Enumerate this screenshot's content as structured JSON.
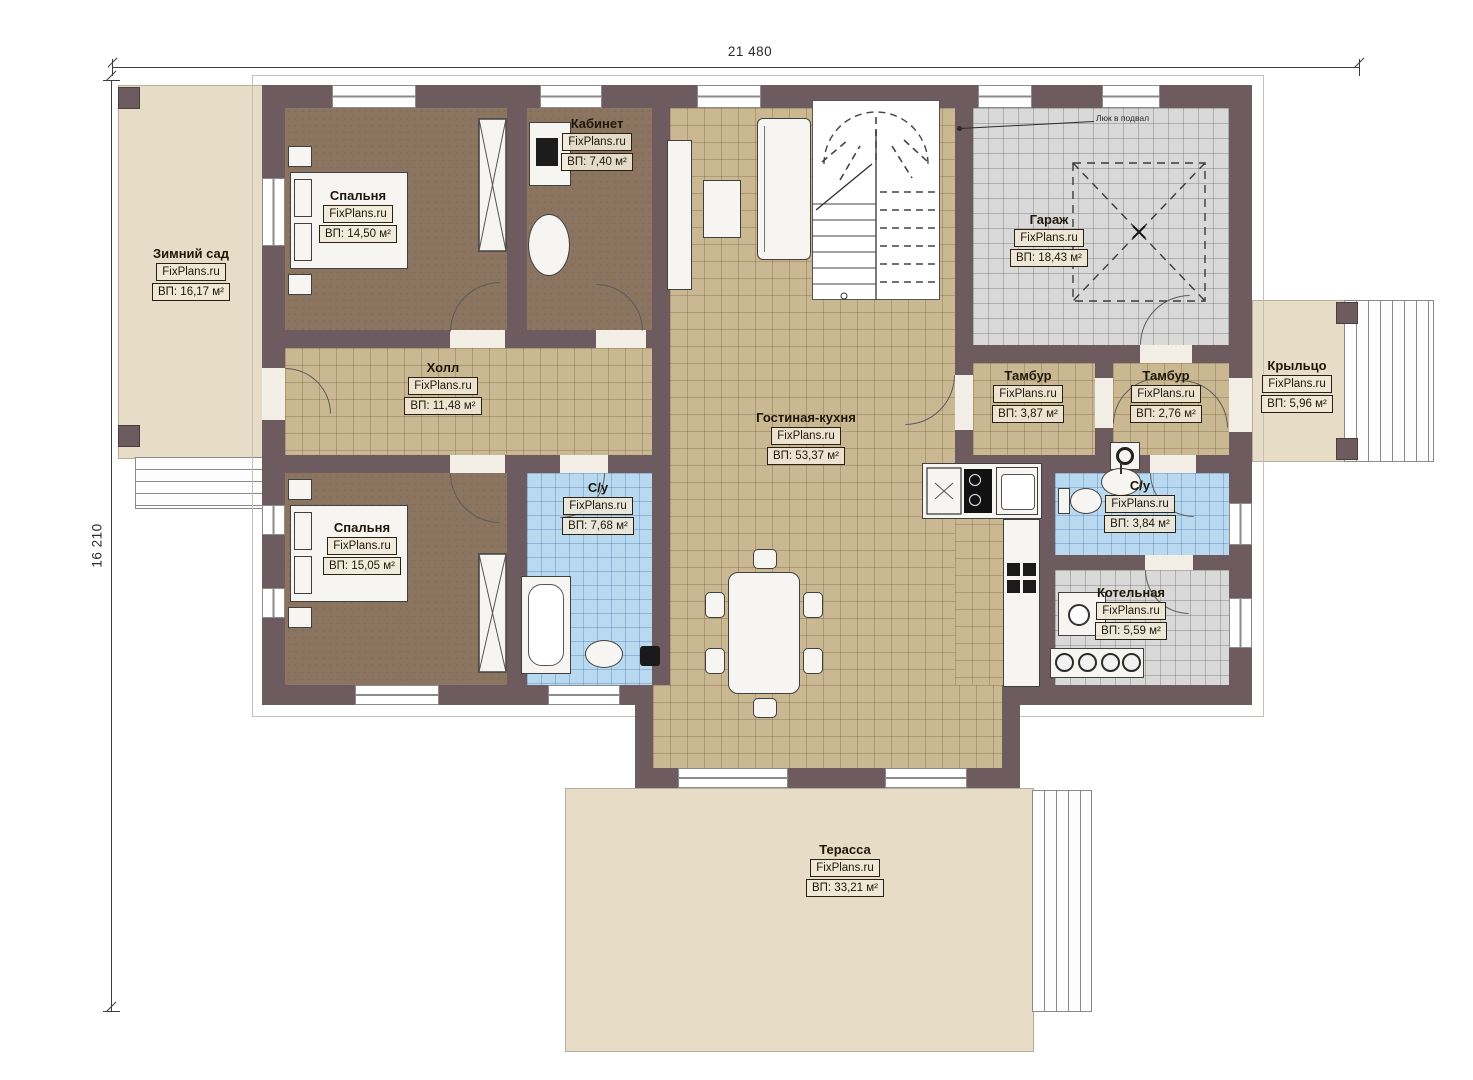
{
  "plan": {
    "watermark": "FixPlans.ru",
    "dim_width": "21 480",
    "dim_height": "16 210",
    "note_basement": "Люк в подвал"
  },
  "rooms": {
    "winter_garden": {
      "name": "Зимний сад",
      "area": "ВП: 16,17 м²"
    },
    "bedroom1": {
      "name": "Спальня",
      "area": "ВП: 14,50 м²"
    },
    "office": {
      "name": "Кабинет",
      "area": "ВП: 7,40 м²"
    },
    "hall": {
      "name": "Холл",
      "area": "ВП: 11,48 м²"
    },
    "bedroom2": {
      "name": "Спальня",
      "area": "ВП: 15,05 м²"
    },
    "bathroom1": {
      "name": "С/у",
      "area": "ВП: 7,68 м²"
    },
    "living_kitchen": {
      "name": "Гостиная-кухня",
      "area": "ВП: 53,37 м²"
    },
    "garage": {
      "name": "Гараж",
      "area": "ВП: 18,43 м²"
    },
    "vestibule1": {
      "name": "Тамбур",
      "area": "ВП: 3,87 м²"
    },
    "vestibule2": {
      "name": "Тамбур",
      "area": "ВП: 2,76 м²"
    },
    "porch": {
      "name": "Крыльцо",
      "area": "ВП: 5,96 м²"
    },
    "bathroom2": {
      "name": "С/у",
      "area": "ВП: 3,84 м²"
    },
    "boiler_room": {
      "name": "Котельная",
      "area": "ВП: 5,59 м²"
    },
    "terrace": {
      "name": "Терасса",
      "area": "ВП: 33,21 м²"
    }
  }
}
